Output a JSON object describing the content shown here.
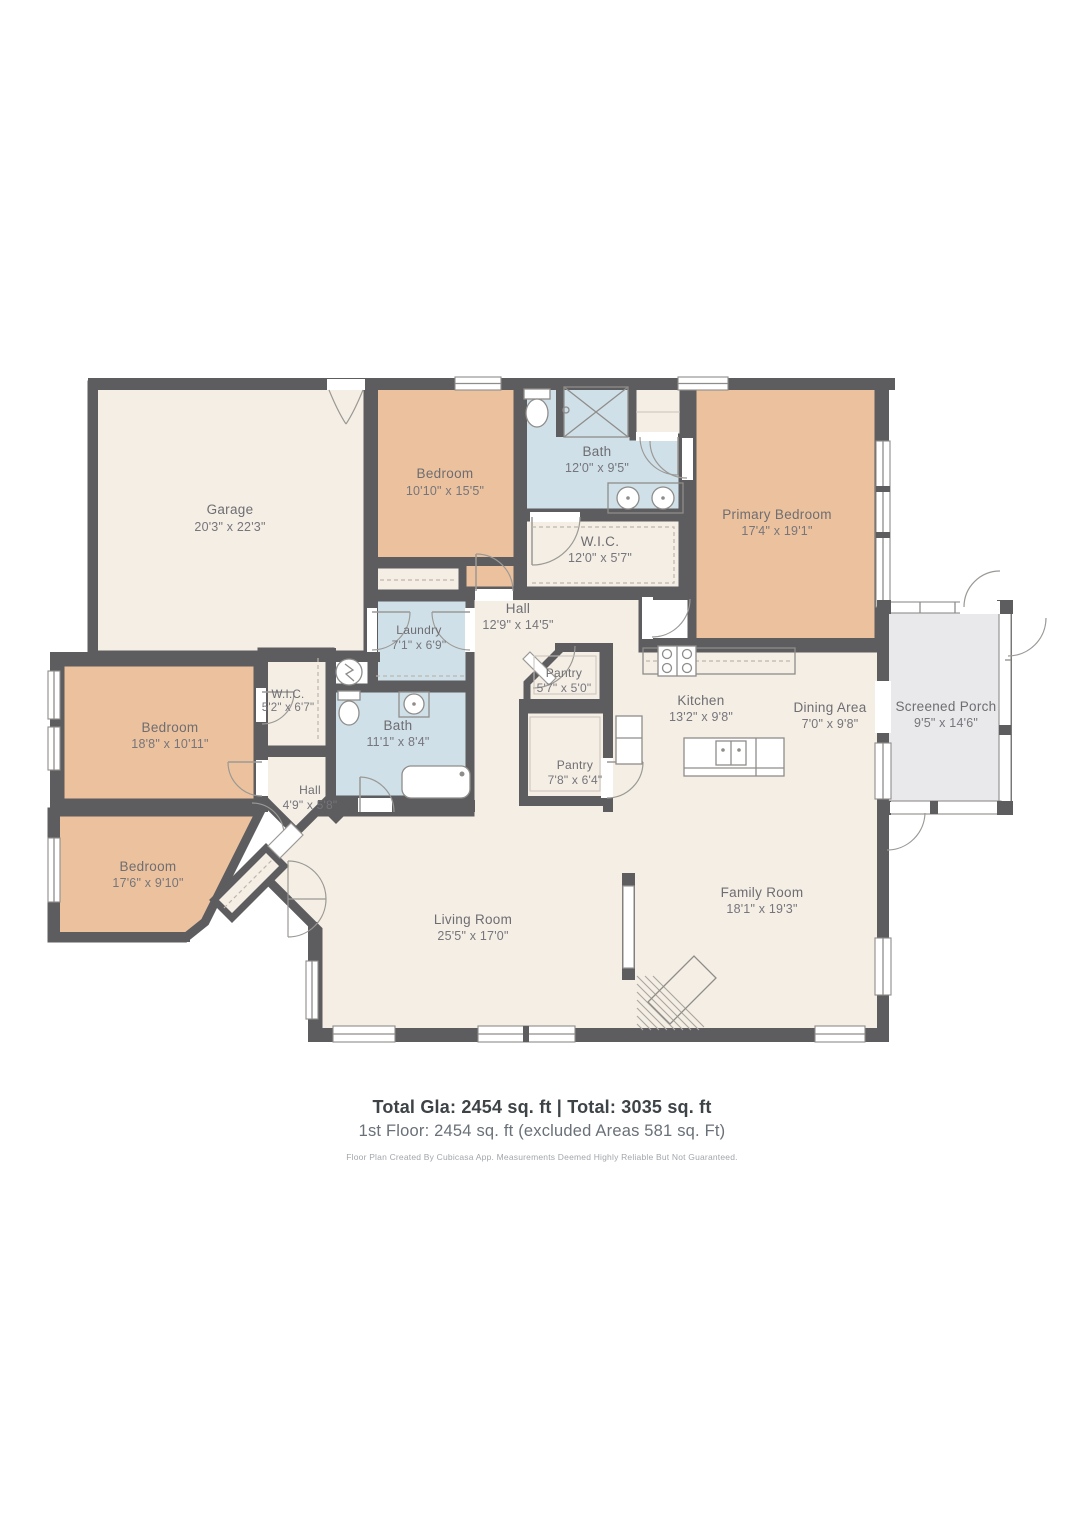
{
  "floor_plan": {
    "rooms": [
      {
        "name": "Garage",
        "dims": "20'3\" x 22'3\""
      },
      {
        "name": "Bedroom",
        "dims": "10'10\" x 15'5\""
      },
      {
        "name": "Bath",
        "dims": "12'0\" x 9'5\""
      },
      {
        "name": "W.I.C.",
        "dims": "12'0\" x 5'7\""
      },
      {
        "name": "Primary Bedroom",
        "dims": "17'4\" x 19'1\""
      },
      {
        "name": "Hall",
        "dims": "12'9\" x 14'5\""
      },
      {
        "name": "Laundry",
        "dims": "7'1\" x 6'9\""
      },
      {
        "name": "Pantry",
        "dims": "5'7\" x 5'0\""
      },
      {
        "name": "Kitchen",
        "dims": "13'2\" x 9'8\""
      },
      {
        "name": "Dining Area",
        "dims": "7'0\" x 9'8\""
      },
      {
        "name": "Screened Porch",
        "dims": "9'5\" x 14'6\""
      },
      {
        "name": "Bedroom",
        "dims": "18'8\" x 10'11\""
      },
      {
        "name": "W.I.C.",
        "dims": "5'2\" x 6'7\""
      },
      {
        "name": "Bath",
        "dims": "11'1\" x 8'4\""
      },
      {
        "name": "Hall",
        "dims": "4'9\" x 5'8\""
      },
      {
        "name": "Bedroom",
        "dims": "17'6\" x 9'10\""
      },
      {
        "name": "Pantry",
        "dims": "7'8\" x 6'4\""
      },
      {
        "name": "Living Room",
        "dims": "25'5\" x 17'0\""
      },
      {
        "name": "Family Room",
        "dims": "18'1\" x 19'3\""
      }
    ],
    "footer": {
      "summary_bold": "Total Gla: 2454 sq. ft | Total: 3035 sq. ft",
      "floor_line": "1st Floor: 2454 sq. ft (excluded Areas 581 sq. Ft)",
      "disclaimer": "Floor Plan Created By Cubicasa App. Measurements Deemed Highly Reliable But Not Guaranteed."
    },
    "colors": {
      "wall": "#5d5c5e",
      "room_cream": "#f4eee5",
      "room_peach": "#ecc29e",
      "room_blue": "#cfe0e8",
      "porch_gray": "#e9e9eb",
      "label_text": "#6e6d71"
    }
  }
}
